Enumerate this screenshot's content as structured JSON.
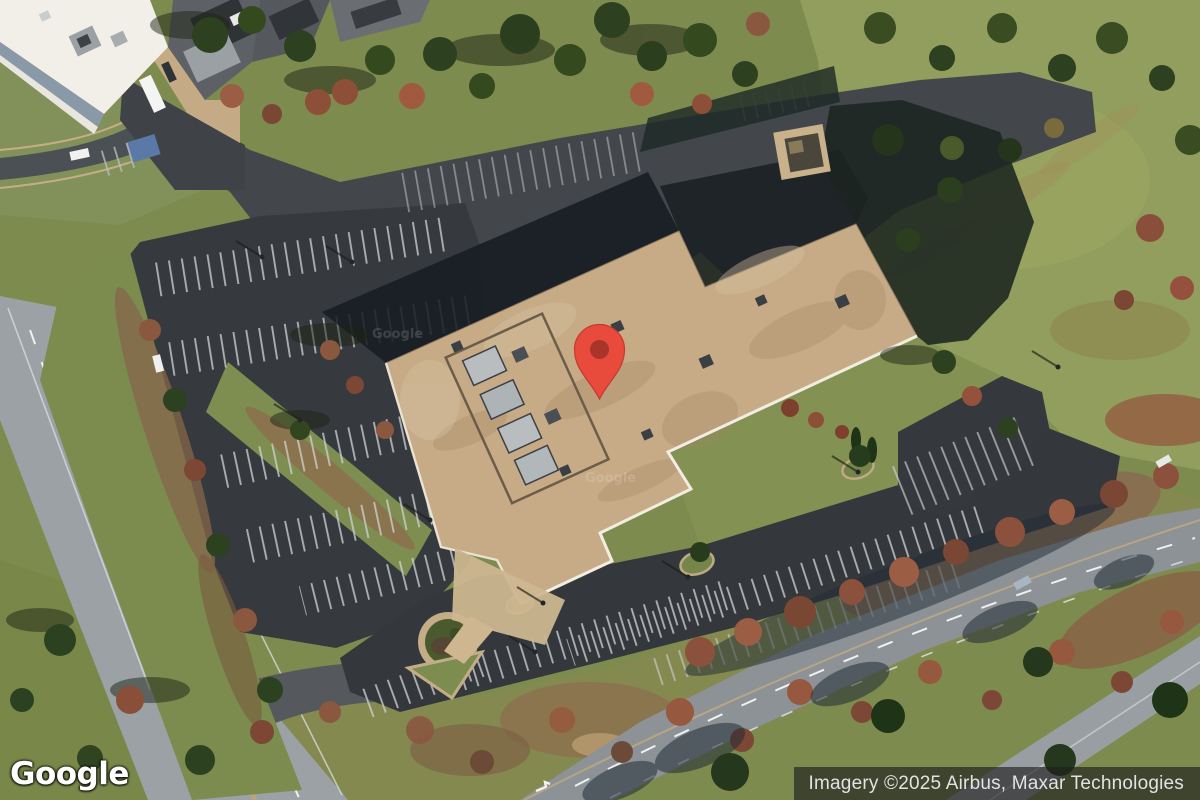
{
  "map": {
    "view_type": "satellite",
    "logo": "Google",
    "attribution": "Imagery ©2025 Airbus, Maxar Technologies",
    "watermark": "Google"
  },
  "marker": {
    "kind": "red-location-pin",
    "x": 598,
    "y": 350
  },
  "colors": {
    "pin_red": "#E84B3C",
    "pin_red_edge": "#C53A2D",
    "pin_inner": "#A8342A",
    "grass": "#7d8b4f",
    "hill_grass": "#919e5d",
    "asphalt_lot": "#36393d",
    "asphalt_drive": "#43474b",
    "road_light": "#9ba1a4",
    "roof_tan": "#c7ab87",
    "roof_white": "#f2efe8",
    "attribution_bg": "#1e1e1e",
    "attribution_text": "#e2e2e2"
  }
}
